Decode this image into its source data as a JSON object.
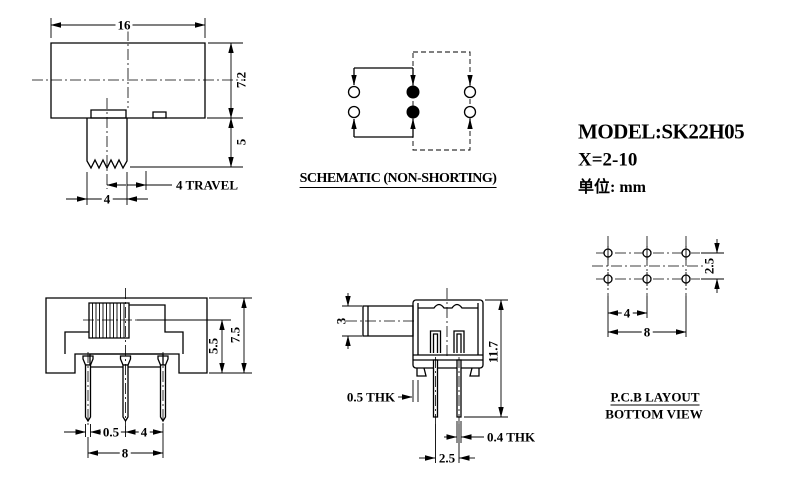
{
  "title_block": {
    "model_label": "MODEL:SK22H05",
    "variant_label": "X=2-10",
    "unit_label": "单位: mm"
  },
  "front_view": {
    "dim_width": "16",
    "dim_body_height": "7.2",
    "dim_knob_height": "5",
    "dim_travel": "4 TRAVEL",
    "dim_knob_width": "4"
  },
  "schematic": {
    "caption": "SCHEMATIC (NON-SHORTING)"
  },
  "side_view": {
    "dim_total_height": "7.5",
    "dim_upper_height": "5.5",
    "dim_pin_width": "0.5",
    "dim_pin_pitch": "4",
    "dim_pin_span": "8"
  },
  "profile_view": {
    "dim_knob_height": "3",
    "dim_total_height": "11.7",
    "dim_shell_thickness": "0.5 THK",
    "dim_pin_thickness": "0.4 THK",
    "dim_pin_pitch": "2.5"
  },
  "pcb_layout": {
    "caption_line1": "P.C.B LAYOUT",
    "caption_line2": "BOTTOM VIEW",
    "dim_row_pitch": "2.5",
    "dim_col_pitch": "4",
    "dim_span": "8"
  }
}
